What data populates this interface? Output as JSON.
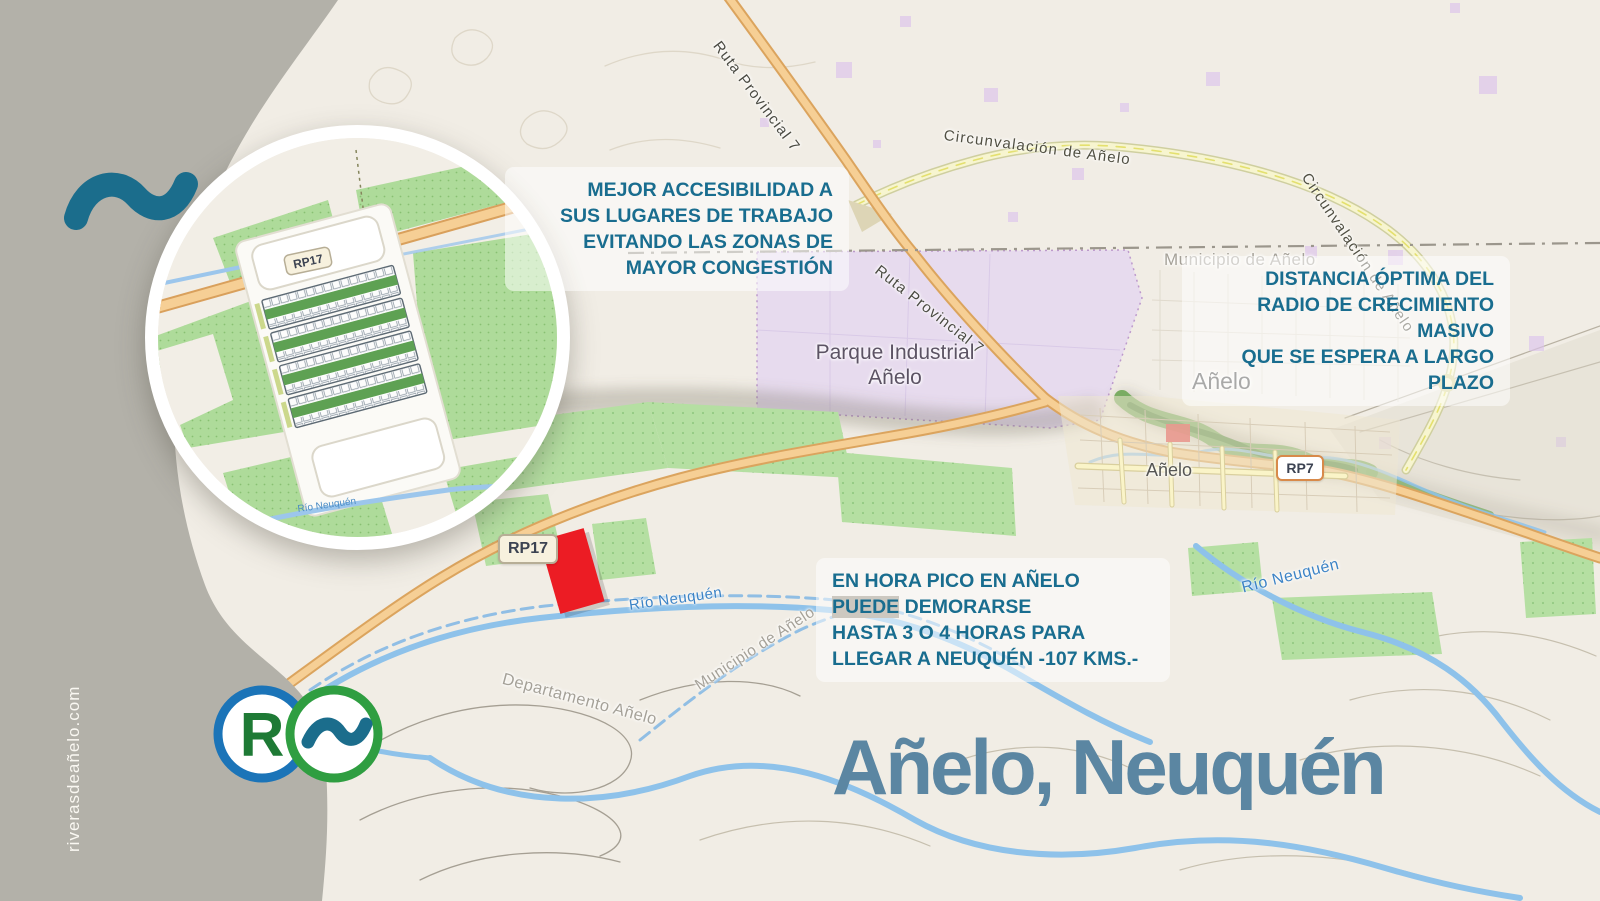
{
  "branding": {
    "watermark": "riverasdeañelo.com",
    "logo_letter": "R",
    "title": "Añelo, Neuquén",
    "colors": {
      "teal_text": "#196d8f",
      "title_blue": "#5b86a2",
      "logo_green": "#2f9e41",
      "logo_blue": "#1b74b8",
      "brand_tilde_teal": "#1b6d8c",
      "panel_gray": "#b3b1a9",
      "marker_red": "#ec1c24",
      "park_purple": "#e6d9f0",
      "field_green": "#b5dfa2",
      "road_orange": "#f6cf95",
      "river_blue": "#8ec2ea"
    }
  },
  "annotations": {
    "accessibility": {
      "lines": [
        "MEJOR ACCESIBILIDAD A",
        "SUS LUGARES DE TRABAJO",
        "EVITANDO LAS ZONAS DE",
        "MAYOR CONGESTIÓN"
      ]
    },
    "distance": {
      "lines": [
        "DISTANCIA ÓPTIMA DEL",
        "RADIO DE CRECIMIENTO MASIVO",
        "QUE SE ESPERA A LARGO PLAZO"
      ]
    },
    "rush_hour": {
      "line1": "EN HORA PICO EN AÑELO",
      "line2_highlight": "PUEDE",
      "line2_rest": " DEMORARSE",
      "line3": "HASTA 3 O 4 HORAS PARA",
      "line4": "LLEGAR A NEUQUÉN -107 KMS.-"
    }
  },
  "map": {
    "roads": {
      "ruta_provincial_7": "Ruta Provincial 7",
      "circunvalacion": "Circunvalación de Añelo",
      "rp17_badge": "RP17",
      "rp7_badge": "RP7"
    },
    "places": {
      "parque_industrial_line1": "Parque Industrial",
      "parque_industrial_line2": "Añelo",
      "town": "Añelo",
      "town_secondary": "Añelo",
      "municipio": "Municipio de Añelo",
      "departamento": "Departamento Añelo"
    },
    "water": {
      "rio": "Río Neuquén"
    }
  }
}
